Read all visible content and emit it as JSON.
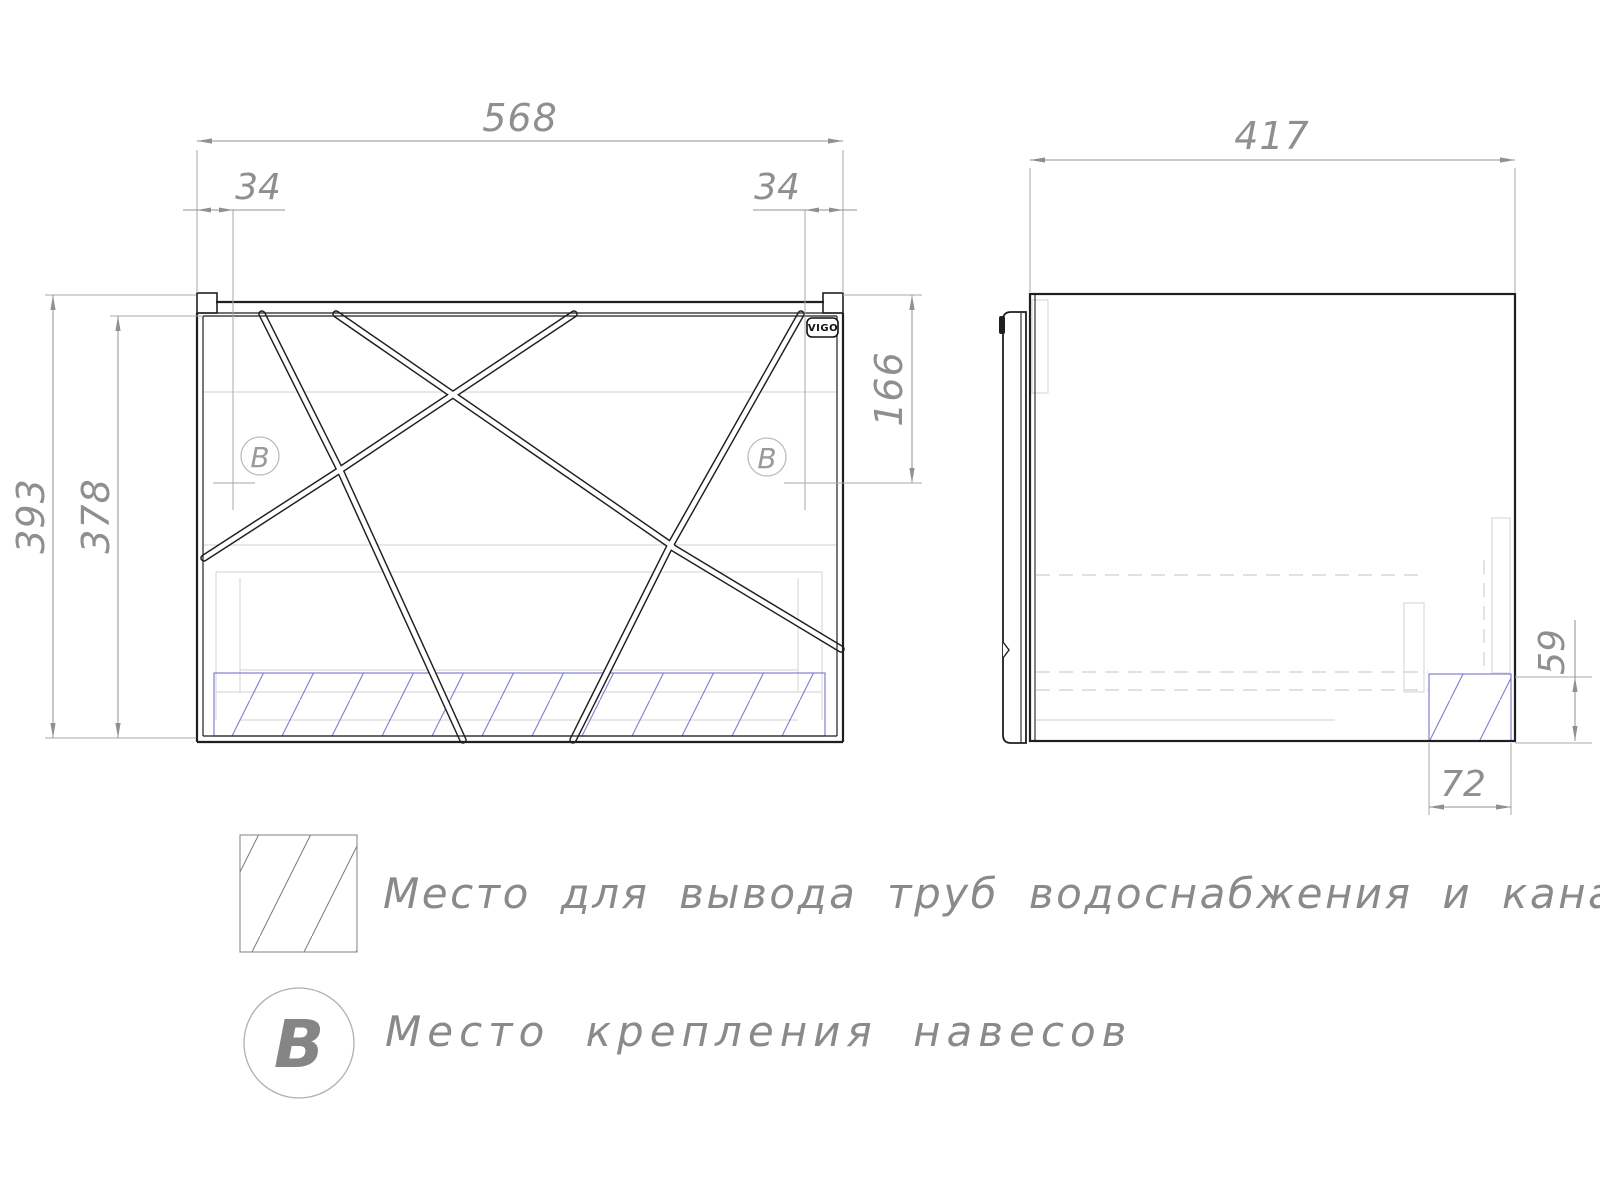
{
  "drawing": {
    "type": "cabinet technical drawing",
    "views": [
      "front",
      "side"
    ]
  },
  "dims": {
    "front_width": "568",
    "front_left_offset": "34",
    "front_right_offset": "34",
    "front_mount_drop": "166",
    "front_height": "393",
    "front_inner_height": "378",
    "side_depth": "417",
    "cutout_height": "59",
    "cutout_width": "72"
  },
  "labels": {
    "brand": "VIGO",
    "mount_point": "B"
  },
  "legend": {
    "pipes_text": "Место для вывода труб водоснабжения и канализации",
    "mount_text": "Место крепления навесов",
    "mount_symbol": "B"
  },
  "colors": {
    "outline": "#1f1f1f",
    "dimension": "#909090",
    "internal_light": "#d9d9d9",
    "hatch_blue": "#7e7ed2",
    "hatch_gray": "#7a7a7a"
  }
}
